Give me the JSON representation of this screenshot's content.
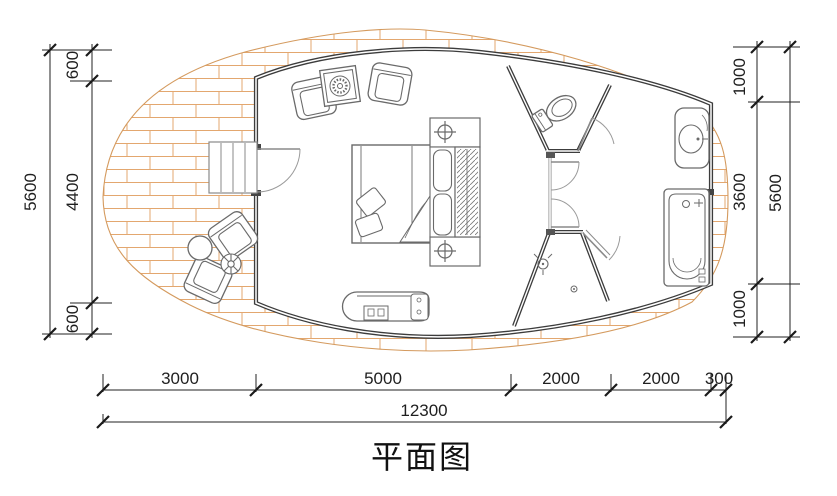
{
  "title": {
    "text": "平面图"
  },
  "dimensions": {
    "left": {
      "total": "5600",
      "segments": [
        "600",
        "4400",
        "600"
      ]
    },
    "right": {
      "total": "5600",
      "segments": [
        "1000",
        "3600",
        "1000"
      ]
    },
    "bottom": {
      "total": "12300",
      "segments": [
        "3000",
        "5000",
        "2000",
        "2000",
        "300"
      ]
    }
  },
  "fixtures": {
    "deck": "wood-deck-terrace",
    "stairs": "entry-stairs",
    "entry_door": "entrance-door",
    "bed": "double-bed",
    "wardrobe": "wardrobe-hanging-rail",
    "nightstands": "bedside-tables-with-lamps",
    "armchair_set": "two-armchairs-with-side-table",
    "deck_set": "outdoor-chairs-with-round-table",
    "lounge": "chaise-lounge",
    "toilet": "toilet",
    "sink": "washbasin",
    "bathtub": "bathtub",
    "shower": "shower-with-floor-drain"
  },
  "colors": {
    "wall": "#3c3c3c",
    "deck_line": "#dca26a",
    "furniture": "#6a6a6a",
    "dimension": "#222222",
    "glass_wall": "#b8b8b8",
    "door_arc": "#9a9a9a"
  }
}
